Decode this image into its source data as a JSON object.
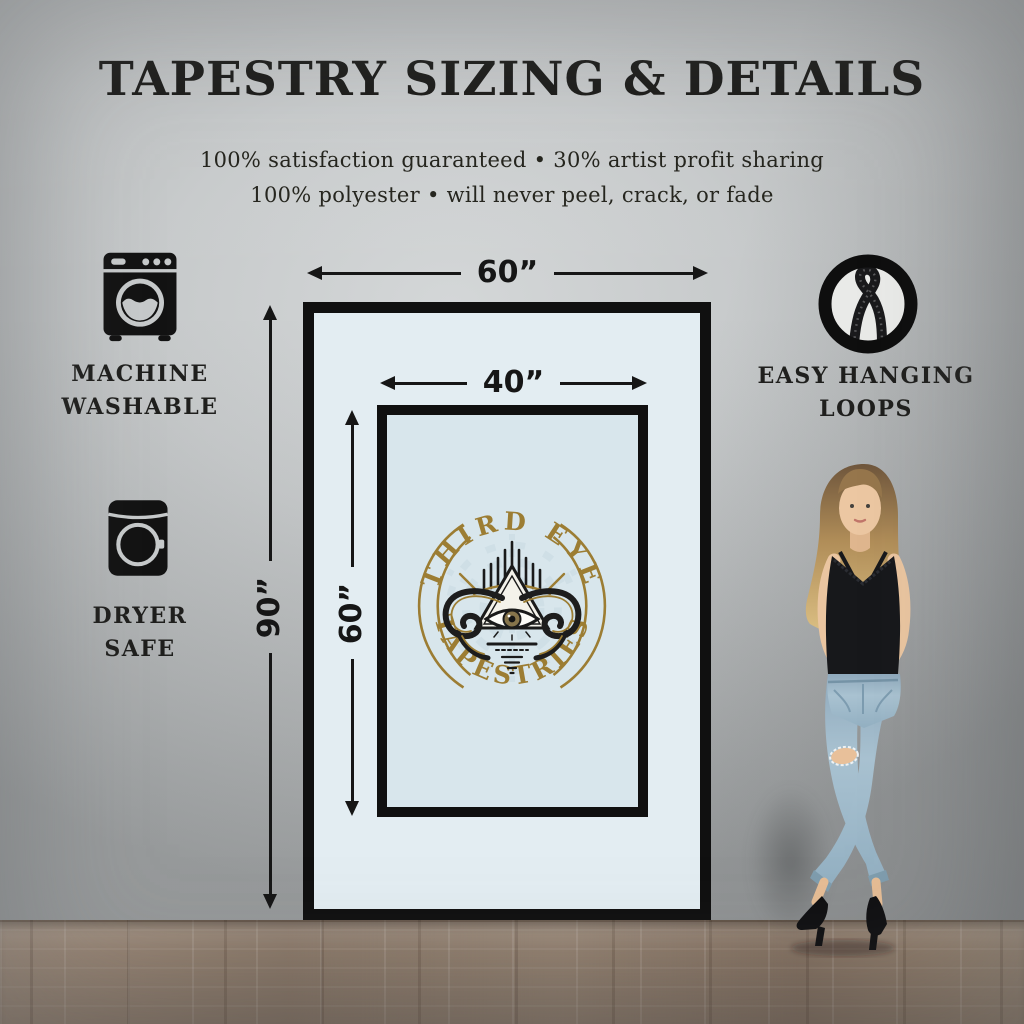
{
  "header": {
    "title": "TAPESTRY SIZING & DETAILS",
    "subtitle_line1": "100% satisfaction guaranteed • 30% artist profit sharing",
    "subtitle_line2": "100% polyester • will never peel, crack, or fade"
  },
  "features": {
    "machine_washable": {
      "line1": "MACHINE",
      "line2": "WASHABLE",
      "icon": "washing-machine-icon"
    },
    "dryer_safe": {
      "line1": "DRYER",
      "line2": "SAFE",
      "icon": "dryer-icon"
    },
    "hanging_loops": {
      "line1": "EASY HANGING",
      "line2": "LOOPS",
      "icon": "hanging-loop-icon"
    }
  },
  "diagram": {
    "outer_width_label": "60”",
    "outer_height_label": "90”",
    "inner_width_label": "40”",
    "inner_height_label": "60”",
    "logo": {
      "top_text": "THIRD EYE",
      "bottom_text": "TAPESTRIES"
    }
  },
  "colors": {
    "logo_gold": "#9c7d33",
    "tapestry_border": "#101010",
    "outer_fill": "#e3edf2",
    "inner_fill": "#d8e6ec",
    "wall": "#c3c6c7",
    "floor": "#8d7b6c",
    "accent_black": "#141414"
  }
}
